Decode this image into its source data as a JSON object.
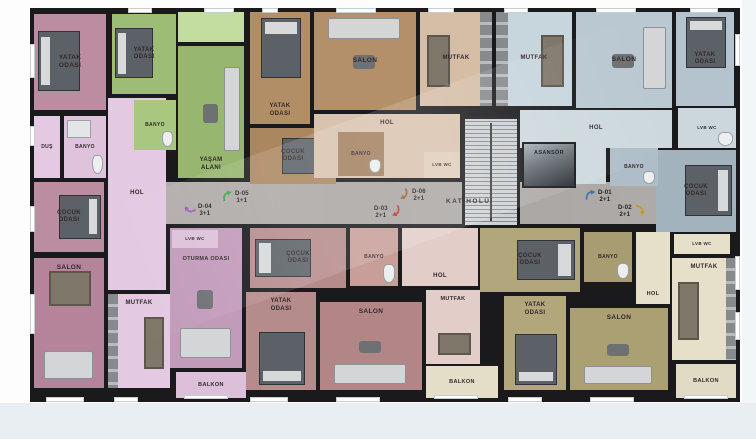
{
  "palette": {
    "wall": "#1a191b",
    "page_bg": "#fdfdfe",
    "footer_bg": "#e9eef3",
    "corridor_bg": "#a9a5a2",
    "unit_colors": {
      "d01_blue": "#b9c8d1",
      "d02_khaki": "#b1a67c",
      "d03_rose": "#b68b8c",
      "d04_pink": "#bc8da1",
      "d05_green": "#9dbc75",
      "d06_tan": "#b4906a"
    }
  },
  "plan": {
    "x": 30,
    "y": 8,
    "w": 710,
    "h": 394
  },
  "corridor": {
    "label": "KAT HOLÜ",
    "label_x": 446,
    "label_y": 198,
    "x": 166,
    "y": 182,
    "w": 490,
    "h": 42
  },
  "unit_tags": [
    {
      "id": "D-04",
      "type": "3+1",
      "x": 184,
      "y": 202,
      "color": "#a159c5",
      "rot": 250,
      "side": "l"
    },
    {
      "id": "D-05",
      "type": "1+1",
      "x": 221,
      "y": 189,
      "color": "#3ea24b",
      "rot": 0,
      "side": "l"
    },
    {
      "id": "D-06",
      "type": "2+1",
      "x": 398,
      "y": 187,
      "color": "#9a6233",
      "rot": 170,
      "side": "l"
    },
    {
      "id": "D-03",
      "type": "2+1",
      "x": 374,
      "y": 204,
      "color": "#bb3a2c",
      "rot": 170,
      "side": "r"
    },
    {
      "id": "D-01",
      "type": "2+1",
      "x": 584,
      "y": 188,
      "color": "#3e76b4",
      "rot": 10,
      "side": "l"
    },
    {
      "id": "D-02",
      "type": "2+1",
      "x": 618,
      "y": 203,
      "color": "#c49a2e",
      "rot": 110,
      "side": "r"
    }
  ],
  "rooms": [
    {
      "name": "d04-hol",
      "label": "HOL",
      "x": 108,
      "y": 98,
      "w": 58,
      "h": 192,
      "bg": "#e3c9e1",
      "fs": 6
    },
    {
      "name": "d04-yatak-odasi",
      "label": "YATAK\nODASI",
      "x": 34,
      "y": 14,
      "w": 72,
      "h": 96,
      "bg": "#bc8da1",
      "decor": [
        "bed-w"
      ]
    },
    {
      "name": "d04-dus",
      "label": "DUŞ",
      "x": 34,
      "y": 116,
      "w": 26,
      "h": 62,
      "bg": "#e3c9e1",
      "fs": 5
    },
    {
      "name": "d04-banyo",
      "label": "BANYO",
      "x": 64,
      "y": 116,
      "w": 42,
      "h": 62,
      "bg": "#dfc3dd",
      "fs": 5,
      "decor": [
        "bath-n",
        "wc"
      ]
    },
    {
      "name": "d04-cocuk-odasi",
      "label": "ÇOCUK\nODASI",
      "x": 34,
      "y": 182,
      "w": 70,
      "h": 70,
      "bg": "#bc8da1",
      "fs": 6,
      "decor": [
        "bed-e"
      ]
    },
    {
      "name": "d04-salon",
      "label": "SALON",
      "x": 34,
      "y": 258,
      "w": 70,
      "h": 130,
      "bg": "#b5849a",
      "lp": "t",
      "decor": [
        "dtable-n",
        "sofa-s"
      ]
    },
    {
      "name": "d04-mutfak",
      "label": "MUTFAK",
      "x": 108,
      "y": 294,
      "w": 62,
      "h": 94,
      "bg": "#e3c9e1",
      "fs": 6,
      "lp": "t",
      "decor": [
        "counter-w",
        "dtable-e"
      ]
    },
    {
      "name": "d04-balkon",
      "label": "BALKON",
      "x": 176,
      "y": 372,
      "w": 70,
      "h": 26,
      "bg": "#dcc0da",
      "fs": 5.5
    },
    {
      "name": "d05-giris",
      "x": 178,
      "y": 12,
      "w": 66,
      "h": 30,
      "bg": "#c3dda0"
    },
    {
      "name": "d05-yatak-odasi",
      "label": "YATAK\nODASI",
      "x": 112,
      "y": 14,
      "w": 64,
      "h": 80,
      "bg": "#9dbc75",
      "fs": 6,
      "decor": [
        "bed-w"
      ]
    },
    {
      "name": "d05-yasam-alani",
      "label": "YAŞAM\nALANI",
      "x": 178,
      "y": 46,
      "w": 66,
      "h": 132,
      "bg": "#97b66f",
      "fs": 6,
      "lp": "b",
      "decor": [
        "sofa-e",
        "rtable"
      ]
    },
    {
      "name": "d05-banyo",
      "label": "BANYO",
      "x": 134,
      "y": 100,
      "w": 42,
      "h": 50,
      "bg": "#a9c77f",
      "fs": 5,
      "decor": [
        "wc"
      ]
    },
    {
      "name": "d06-yatak-odasi",
      "label": "YATAK\nODASI",
      "x": 250,
      "y": 12,
      "w": 60,
      "h": 112,
      "bg": "#b28e67",
      "fs": 6,
      "lp": "b",
      "decor": [
        "bed-n"
      ]
    },
    {
      "name": "d06-cocuk-odasi",
      "label": "ÇOCUK\nODASI",
      "x": 250,
      "y": 128,
      "w": 86,
      "h": 56,
      "bg": "#ab875f",
      "fs": 6,
      "decor": [
        "bed-e"
      ]
    },
    {
      "name": "d06-salon",
      "label": "SALON",
      "x": 314,
      "y": 12,
      "w": 102,
      "h": 98,
      "bg": "#b4906a",
      "decor": [
        "sofa-n",
        "rtable"
      ]
    },
    {
      "name": "d06-hol",
      "label": "HOL",
      "x": 314,
      "y": 114,
      "w": 146,
      "h": 64,
      "bg": "#d9c3ae",
      "fs": 6,
      "lp": "t"
    },
    {
      "name": "d06-banyo",
      "label": "BANYO",
      "x": 338,
      "y": 132,
      "w": 46,
      "h": 44,
      "bg": "#a3815f",
      "fs": 5,
      "decor": [
        "wc"
      ]
    },
    {
      "name": "d06-lvb-wc",
      "label": "LVB WC",
      "x": 424,
      "y": 152,
      "w": 36,
      "h": 26,
      "bg": "#e0cdb9",
      "fs": 4.5
    },
    {
      "name": "d06-mutfak",
      "label": "MUTFAK",
      "x": 420,
      "y": 12,
      "w": 72,
      "h": 94,
      "bg": "#d5bda6",
      "fs": 6,
      "decor": [
        "dtable-w",
        "counter-e"
      ]
    },
    {
      "name": "d01-mutfak",
      "label": "MUTFAK",
      "x": 496,
      "y": 12,
      "w": 76,
      "h": 94,
      "bg": "#c7d5dd",
      "fs": 6,
      "decor": [
        "counter-w",
        "dtable-e"
      ]
    },
    {
      "name": "d01-hol",
      "label": "HOL",
      "x": 520,
      "y": 110,
      "w": 152,
      "h": 38,
      "bg": "#cdd8de",
      "fs": 6
    },
    {
      "name": "d01-hol-2",
      "x": 576,
      "y": 148,
      "w": 30,
      "h": 36,
      "bg": "#cdd8de"
    },
    {
      "name": "d01-salon",
      "label": "SALON",
      "x": 576,
      "y": 12,
      "w": 96,
      "h": 96,
      "bg": "#b9c8d1",
      "decor": [
        "sofa-e",
        "rtable"
      ]
    },
    {
      "name": "d01-yatak-odasi",
      "label": "YATAK\nODASI",
      "x": 676,
      "y": 12,
      "w": 58,
      "h": 94,
      "bg": "#b4c3cd",
      "fs": 6,
      "decor": [
        "bed-n"
      ]
    },
    {
      "name": "d01-lvb-wc",
      "label": "LVB WC",
      "x": 678,
      "y": 108,
      "w": 58,
      "h": 40,
      "bg": "#ccd7dd",
      "fs": 4.5,
      "decor": [
        "wc"
      ]
    },
    {
      "name": "d01-cocuk-odasi",
      "label": "ÇOCUK\nODASI",
      "x": 656,
      "y": 150,
      "w": 80,
      "h": 82,
      "bg": "#a3b3be",
      "fs": 6,
      "decor": [
        "bed-e"
      ]
    },
    {
      "name": "d01-banyo",
      "label": "BANYO",
      "x": 610,
      "y": 148,
      "w": 48,
      "h": 38,
      "bg": "#aebdc8",
      "fs": 5,
      "decor": [
        "wc"
      ]
    },
    {
      "name": "asansor",
      "label": "ASANSÖR",
      "x": 522,
      "y": 142,
      "w": 54,
      "h": 46,
      "bg": "#8d969c",
      "fs": 5.5,
      "lp": "t",
      "cls": "elevator"
    },
    {
      "name": "merdiven",
      "x": 462,
      "y": 116,
      "w": 58,
      "h": 112,
      "bg": "#c9cccf",
      "cls": "stairs"
    },
    {
      "name": "oturma-odasi",
      "label": "OTURMA ODASI",
      "x": 170,
      "y": 228,
      "w": 72,
      "h": 140,
      "bg": "#c29bbb",
      "fs": 5.5,
      "lp": "t",
      "pt": 28,
      "decor": [
        "sofa-s",
        "rtable"
      ]
    },
    {
      "name": "d04-lvb-wc",
      "label": "LVB WC",
      "x": 172,
      "y": 230,
      "w": 46,
      "h": 18,
      "bg": "#ddc2da",
      "fs": 4.5
    },
    {
      "name": "d03-cocuk-odasi",
      "label": "ÇOCUK\nODASI",
      "x": 250,
      "y": 228,
      "w": 96,
      "h": 60,
      "bg": "#b68b8c",
      "fs": 6,
      "decor": [
        "bed-w"
      ]
    },
    {
      "name": "d03-banyo",
      "label": "BANYO",
      "x": 350,
      "y": 228,
      "w": 48,
      "h": 58,
      "bg": "#c79e98",
      "fs": 5,
      "decor": [
        "wc"
      ]
    },
    {
      "name": "d03-hol",
      "label": "HOL",
      "x": 402,
      "y": 228,
      "w": 76,
      "h": 58,
      "bg": "#e2cdc8",
      "fs": 6,
      "lp": "b"
    },
    {
      "name": "d03-mutfak",
      "label": "MUTFAK",
      "x": 426,
      "y": 290,
      "w": 54,
      "h": 74,
      "bg": "#e2cdc8",
      "fs": 5.5,
      "lp": "t",
      "decor": [
        "dtable-s"
      ]
    },
    {
      "name": "d03-yatak-odasi",
      "label": "YATAK\nODASI",
      "x": 246,
      "y": 292,
      "w": 70,
      "h": 98,
      "bg": "#b68b8c",
      "fs": 6,
      "lp": "t",
      "decor": [
        "bed-s"
      ]
    },
    {
      "name": "d03-salon",
      "label": "SALON",
      "x": 320,
      "y": 302,
      "w": 102,
      "h": 88,
      "bg": "#b28587",
      "lp": "t",
      "decor": [
        "sofa-s",
        "rtable"
      ]
    },
    {
      "name": "d03-balkon",
      "label": "BALKON",
      "x": 426,
      "y": 366,
      "w": 72,
      "h": 32,
      "bg": "#e4ddc8",
      "fs": 5.5
    },
    {
      "name": "d02-cocuk-odasi",
      "label": "ÇOCUK\nODASI",
      "x": 480,
      "y": 228,
      "w": 100,
      "h": 64,
      "bg": "#b1a67c",
      "fs": 6,
      "decor": [
        "bed-e"
      ]
    },
    {
      "name": "d02-banyo",
      "label": "BANYO",
      "x": 584,
      "y": 232,
      "w": 48,
      "h": 50,
      "bg": "#a89d72",
      "fs": 5,
      "decor": [
        "wc"
      ]
    },
    {
      "name": "d02-hol",
      "label": "HOL",
      "x": 636,
      "y": 232,
      "w": 34,
      "h": 72,
      "bg": "#e6e0cb",
      "fs": 5.5,
      "lp": "b"
    },
    {
      "name": "d02-lvb-wc",
      "label": "LVB WC",
      "x": 674,
      "y": 234,
      "w": 56,
      "h": 20,
      "bg": "#e6e0cb",
      "fs": 4.5
    },
    {
      "name": "d02-mutfak",
      "label": "MUTFAK",
      "x": 672,
      "y": 258,
      "w": 64,
      "h": 102,
      "bg": "#e6e0cb",
      "fs": 6,
      "lp": "t",
      "decor": [
        "dtable-w",
        "counter-e"
      ]
    },
    {
      "name": "d02-yatak-odasi",
      "label": "YATAK\nODASI",
      "x": 504,
      "y": 296,
      "w": 62,
      "h": 94,
      "bg": "#b1a67c",
      "fs": 6,
      "lp": "t",
      "decor": [
        "bed-s"
      ]
    },
    {
      "name": "d02-salon",
      "label": "SALON",
      "x": 570,
      "y": 308,
      "w": 98,
      "h": 82,
      "bg": "#aaa073",
      "lp": "t",
      "decor": [
        "sofa-s",
        "rtable"
      ]
    },
    {
      "name": "d02-balkon",
      "label": "BALKON",
      "x": 676,
      "y": 364,
      "w": 60,
      "h": 34,
      "bg": "#e1dac4",
      "fs": 5.5
    }
  ],
  "windows": [
    [
      128,
      8,
      24,
      5
    ],
    [
      204,
      8,
      30,
      5
    ],
    [
      262,
      8,
      16,
      5
    ],
    [
      336,
      8,
      40,
      5
    ],
    [
      428,
      8,
      26,
      5
    ],
    [
      504,
      8,
      24,
      5
    ],
    [
      596,
      8,
      40,
      5
    ],
    [
      690,
      8,
      28,
      5
    ],
    [
      30,
      44,
      5,
      34
    ],
    [
      30,
      126,
      5,
      20
    ],
    [
      30,
      206,
      5,
      26
    ],
    [
      30,
      294,
      5,
      40
    ],
    [
      735,
      34,
      5,
      32
    ],
    [
      735,
      256,
      5,
      34
    ],
    [
      735,
      312,
      5,
      28
    ],
    [
      46,
      397,
      38,
      5
    ],
    [
      114,
      397,
      24,
      5
    ],
    [
      184,
      395,
      44,
      4
    ],
    [
      250,
      397,
      38,
      5
    ],
    [
      336,
      397,
      44,
      5
    ],
    [
      434,
      395,
      44,
      4
    ],
    [
      508,
      397,
      34,
      5
    ],
    [
      590,
      397,
      44,
      5
    ],
    [
      684,
      395,
      44,
      4
    ]
  ]
}
